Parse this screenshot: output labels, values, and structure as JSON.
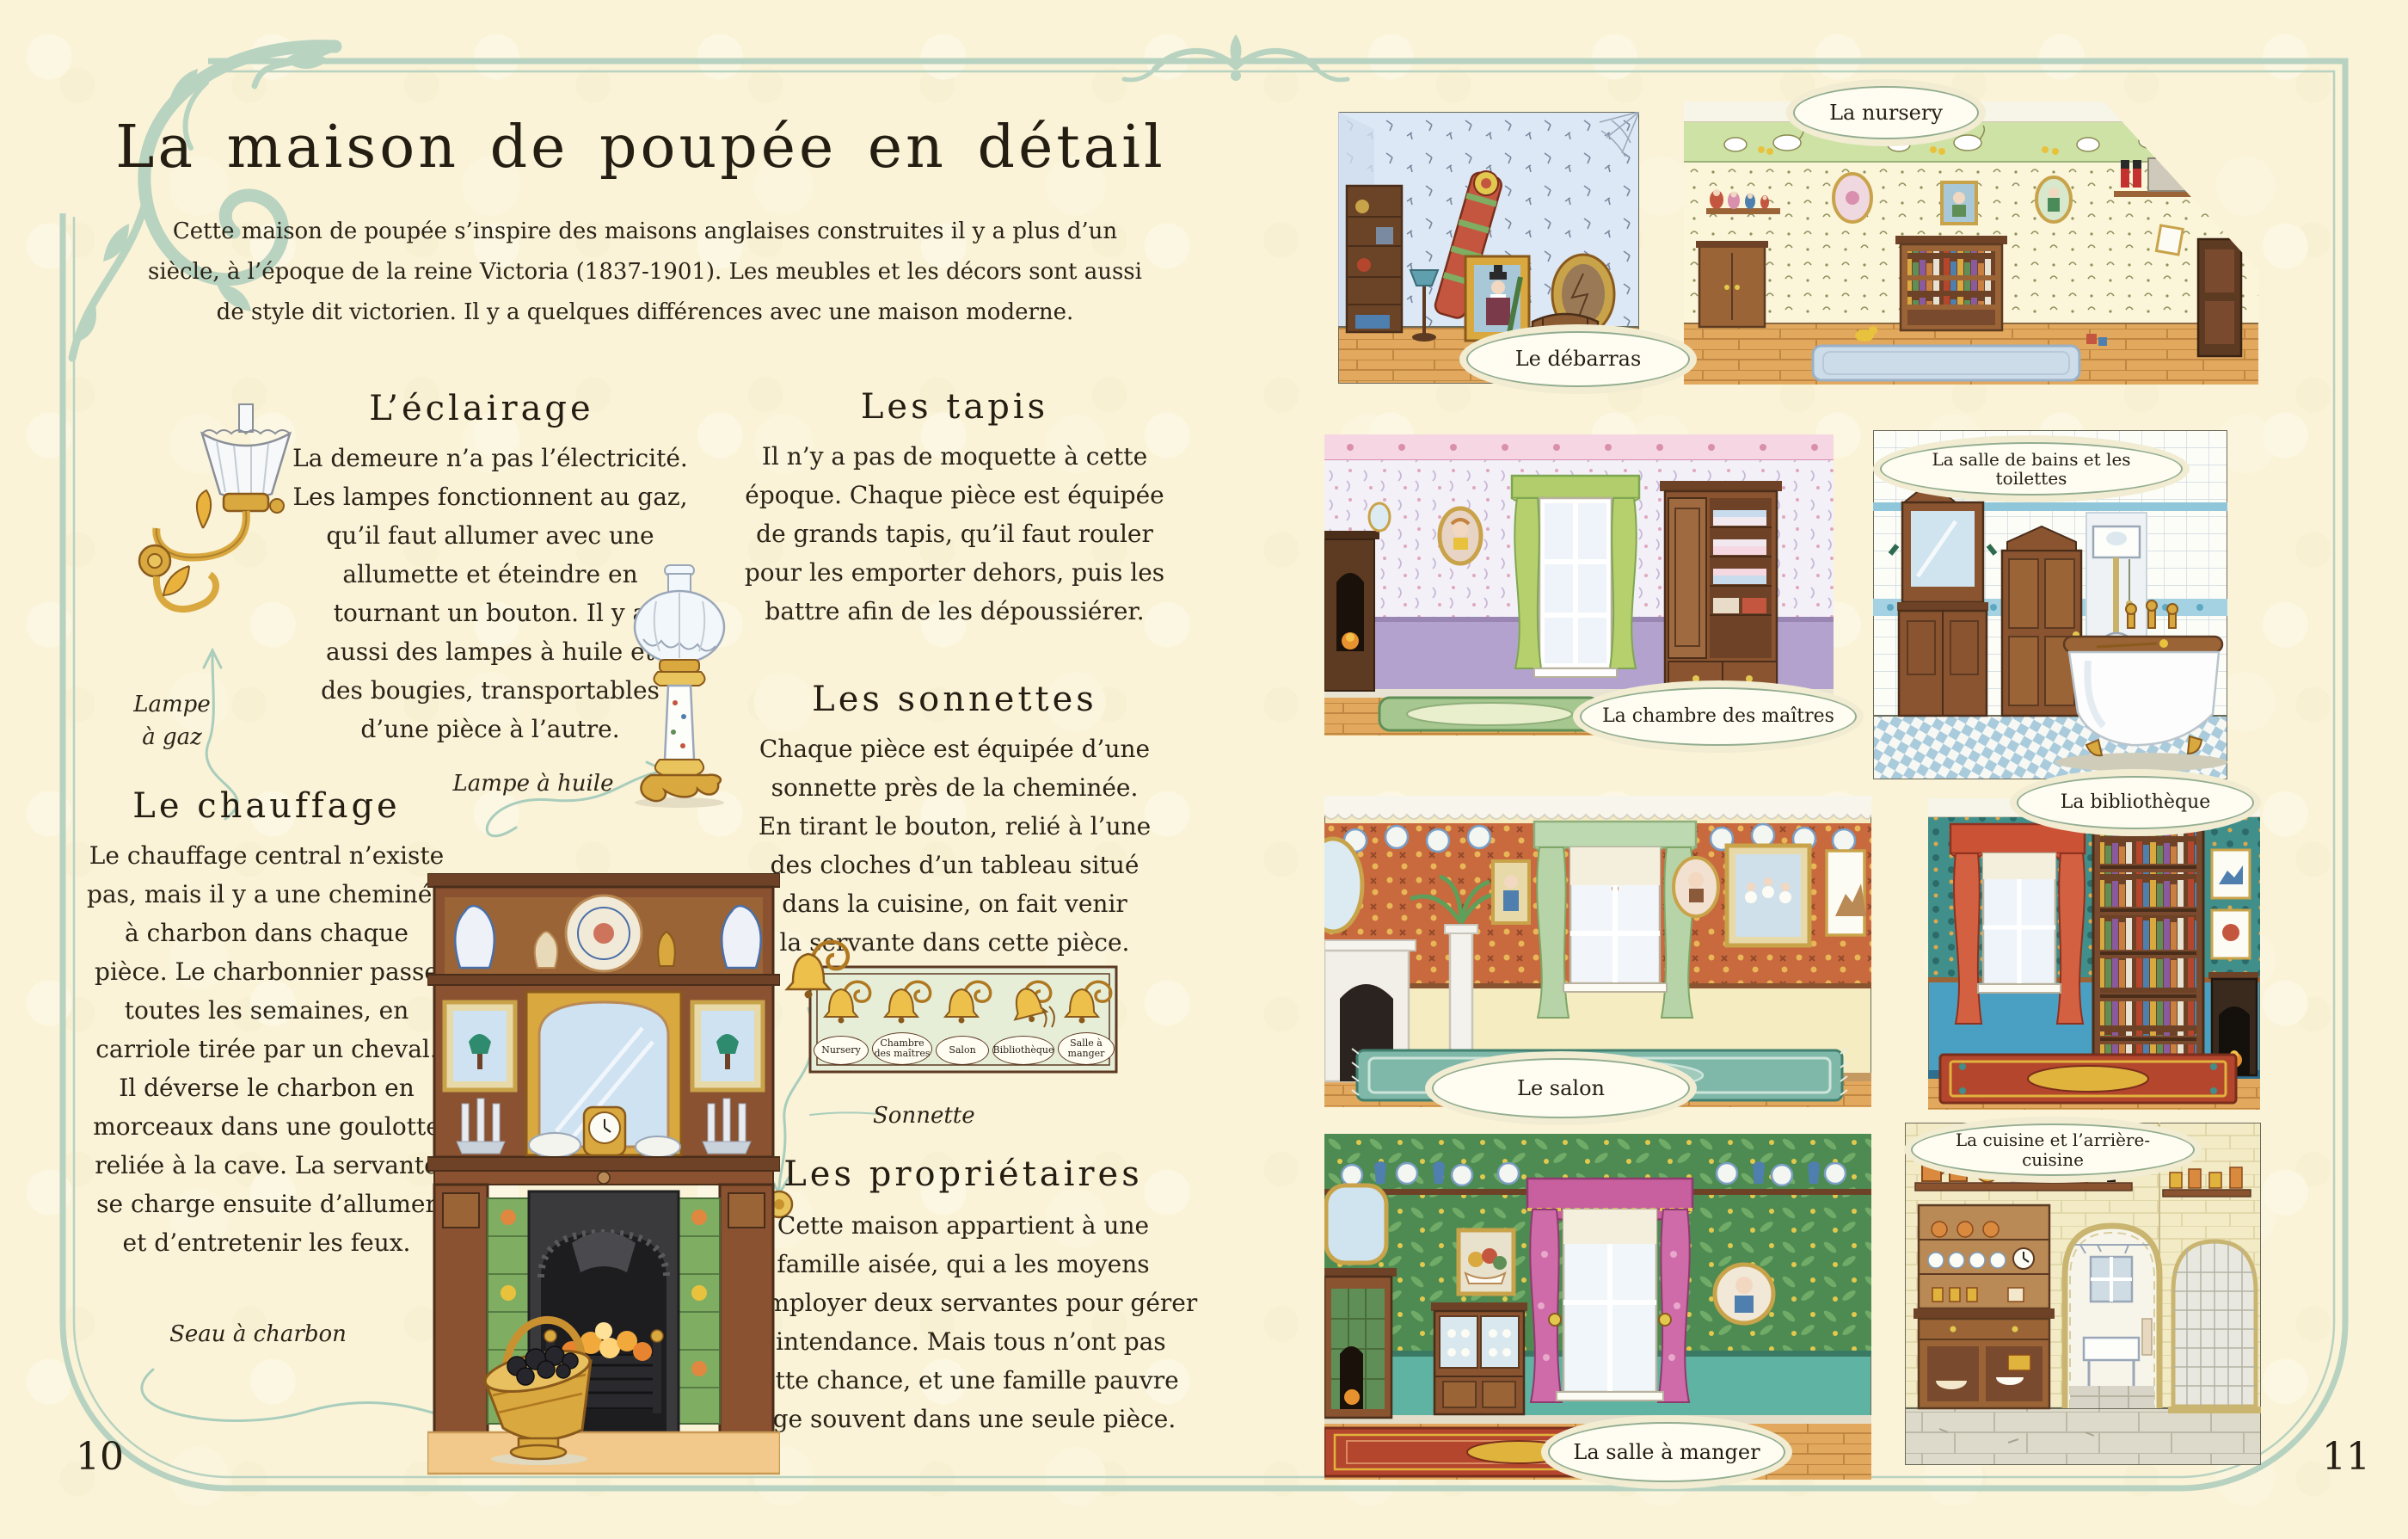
{
  "colors": {
    "paper": "#faf3d7",
    "border_green": "#b7d2c0",
    "ink": "#2a2318",
    "label_border": "#93ad90",
    "bell_gold": "#e8b23a"
  },
  "page_left": {
    "page_number": "10",
    "title": "La maison de poupée en détail",
    "intro": "Cette maison de poupée s’inspire des maisons anglaises construites il y a plus d’un\nsiècle, à l’époque de la reine Victoria (1837-1901). Les meubles et les décors sont aussi\nde style dit victorien. Il y a quelques différences avec une maison moderne.",
    "sections": {
      "eclairage": {
        "heading": "L’éclairage",
        "body": "La demeure n’a pas l’électricité.\nLes lampes fonctionnent au gaz,\nqu’il faut allumer avec une\nallumette et éteindre en\ntournant un bouton. Il y a\naussi des lampes à huile et\ndes bougies, transportables\nd’une pièce à l’autre."
      },
      "chauffage": {
        "heading": "Le chauffage",
        "body": "Le chauffage central n’existe\npas, mais il y a une cheminée\nà charbon dans chaque\npièce. Le charbonnier passe\ntoutes les semaines, en\ncarriole tirée par un cheval.\nIl déverse le charbon en\nmorceaux dans une goulotte\nreliée à la cave. La servante\nse charge ensuite d’allumer\net d’entretenir les feux."
      },
      "tapis": {
        "heading": "Les tapis",
        "body": "Il n’y a pas de moquette à cette\népoque. Chaque pièce est équipée\nde grands tapis, qu’il faut rouler\npour les emporter dehors, puis les\nbattre afin de les dépoussiérer."
      },
      "sonnettes": {
        "heading": "Les sonnettes",
        "body": "Chaque pièce est équipée d’une\nsonnette près de la cheminée.\nEn tirant le bouton, relié à l’une\ndes cloches d’un tableau situé\ndans la cuisine, on fait venir\nla servante dans cette pièce."
      },
      "proprietaires": {
        "heading": "Les propriétaires",
        "body": "Cette maison appartient à une\nfamille aisée, qui a les moyens\nd’employer deux servantes pour gérer\nl’intendance. Mais tous n’ont pas\ncette chance, et une famille pauvre\nloge souvent dans une seule pièce."
      }
    },
    "captions": {
      "gas_lamp": "Lampe\nà gaz",
      "oil_lamp": "Lampe à huile",
      "coal_bucket": "Seau à charbon",
      "bell_pull": "Sonnette"
    },
    "bell_panel": {
      "labels": [
        "Nursery",
        "Chambre\ndes maîtres",
        "Salon",
        "Bibliothèque",
        "Salle à\nmanger"
      ]
    }
  },
  "page_right": {
    "page_number": "11",
    "rooms": [
      {
        "key": "debarras",
        "label": "Le débarras"
      },
      {
        "key": "nursery",
        "label": "La nursery"
      },
      {
        "key": "chambre-des-maitres",
        "label": "La chambre des maîtres"
      },
      {
        "key": "salle-de-bains",
        "label": "La salle de bains et les toilettes"
      },
      {
        "key": "salon",
        "label": "Le salon"
      },
      {
        "key": "bibliotheque",
        "label": "La bibliothèque"
      },
      {
        "key": "salle-a-manger",
        "label": "La salle à manger"
      },
      {
        "key": "cuisine",
        "label": "La cuisine et l’arrière-cuisine"
      }
    ]
  }
}
